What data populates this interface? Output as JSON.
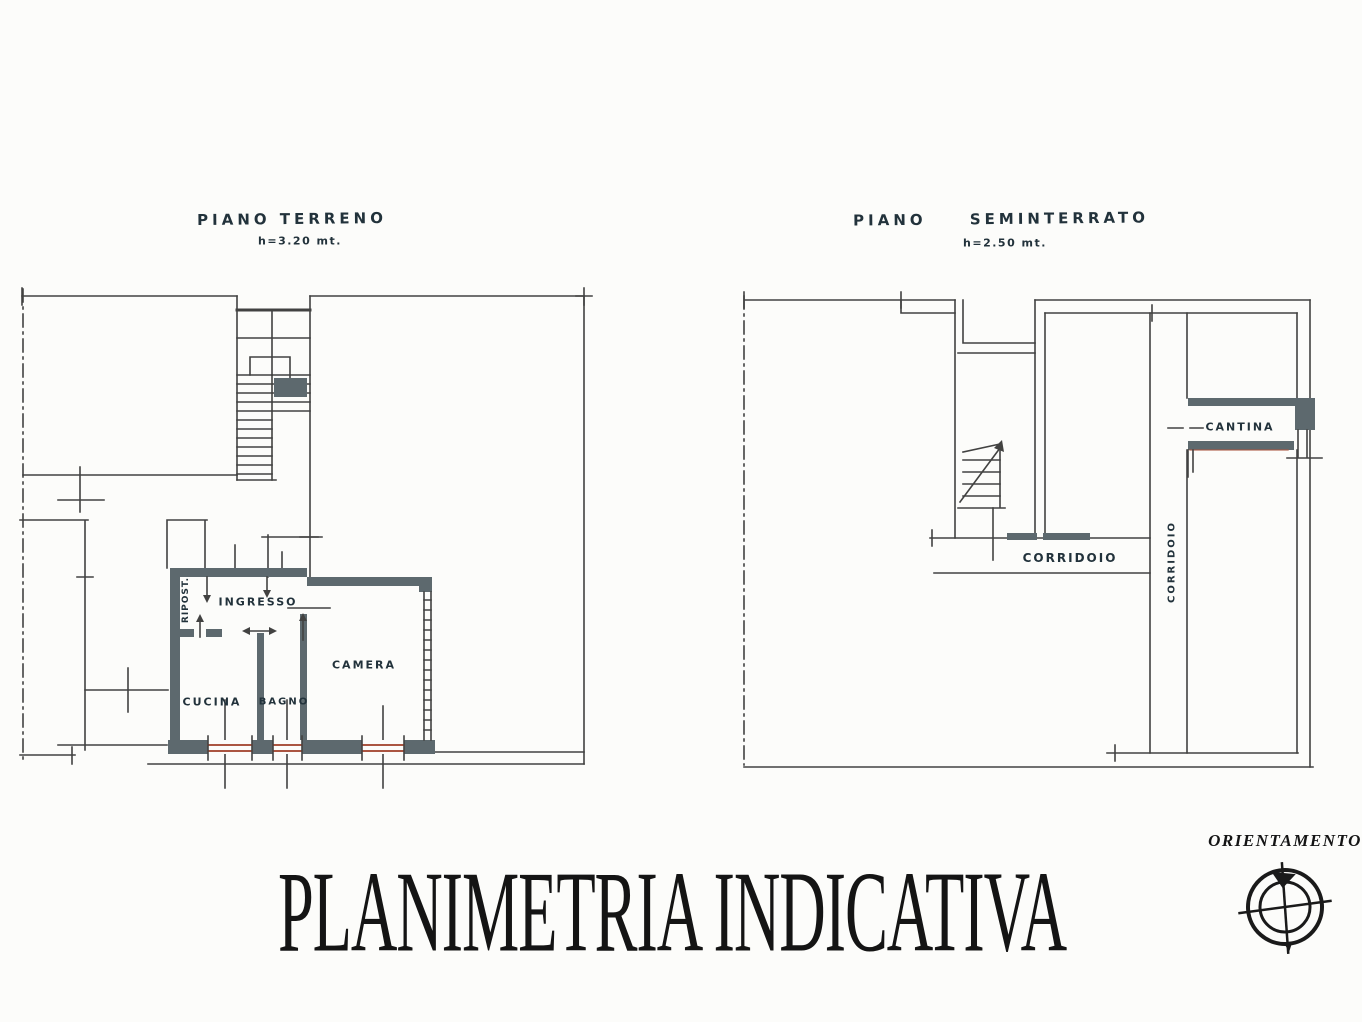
{
  "doc": {
    "title": "PLANIMETRIA INDICATIVA",
    "orientation_label": "ORIENTAMENTO"
  },
  "ground": {
    "title": "PIANO TERRENO",
    "height_note": "h=3.20 mt.",
    "labels": {
      "ripost": "RIPOST.",
      "ingresso": "INGRESSO",
      "cucina": "CUCINA",
      "bagno": "BAGNO",
      "camera": "CAMERA"
    }
  },
  "basement": {
    "title": "PIANO SEMINTERRATO",
    "height_note": "h=2.50 mt.",
    "labels": {
      "corridoio_h": "CORRIDOIO",
      "corridoio_v": "CORRIDOIO",
      "cantina": "CANTINA"
    }
  },
  "colors": {
    "ink": "#2e2e2e",
    "ink_hand": "#22323b",
    "wall": "#4c5a5f",
    "window": "#a3442e",
    "paper": "#fcfcfa"
  }
}
